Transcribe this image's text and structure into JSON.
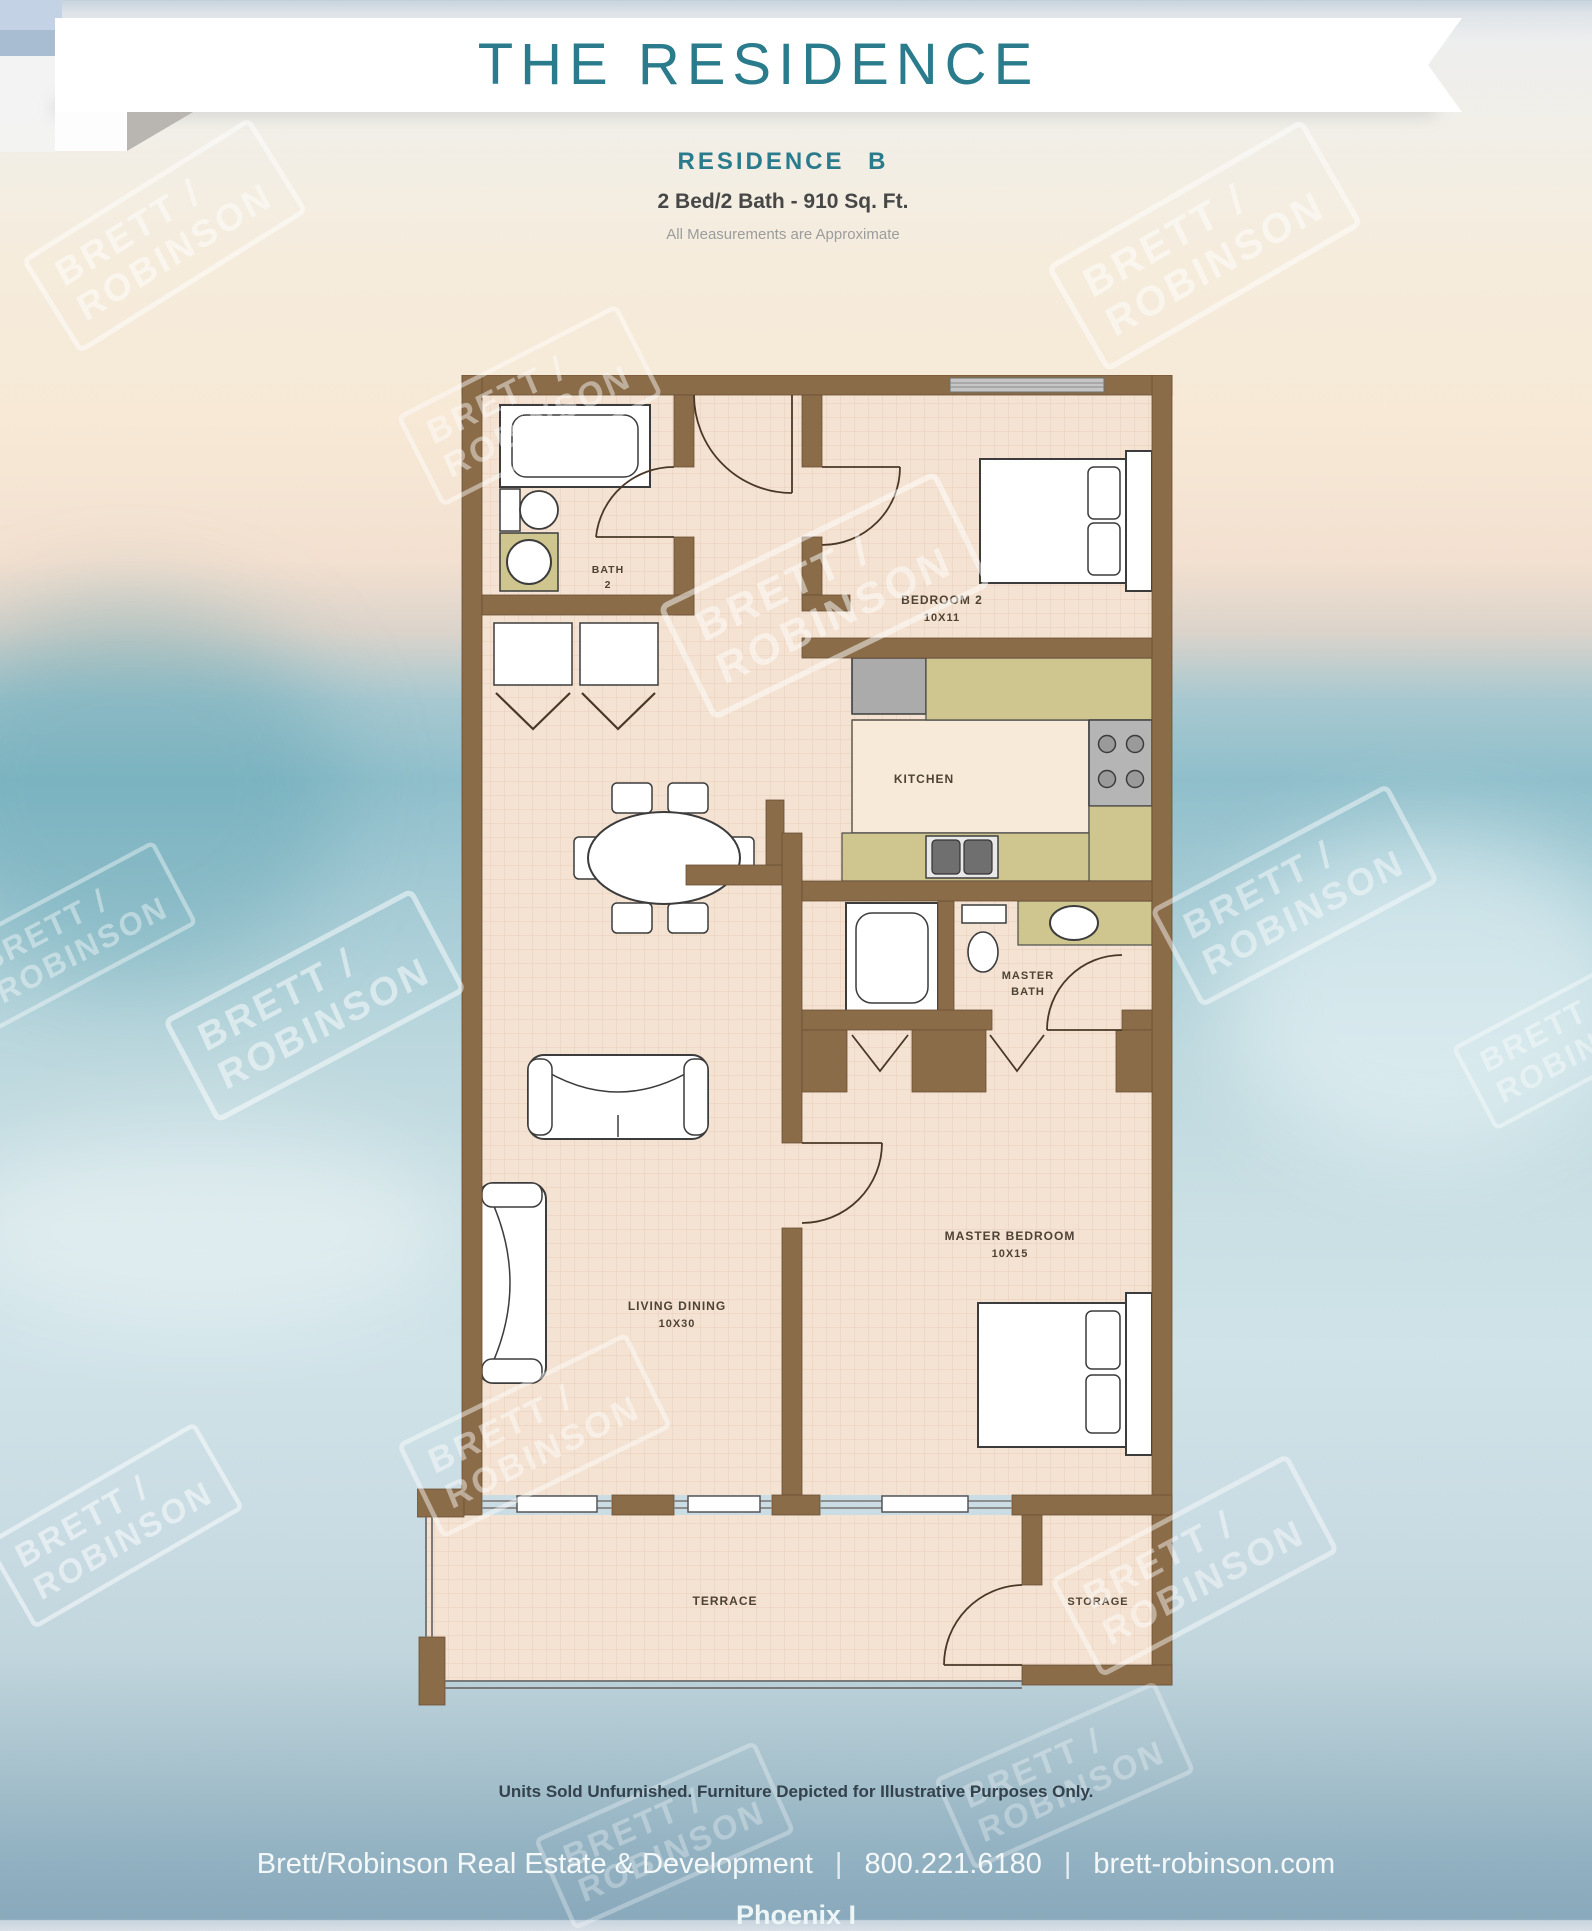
{
  "banner": {
    "title": "THE RESIDENCE"
  },
  "subtitle": {
    "residence": "RESIDENCE B",
    "specs": "2 Bed/2 Bath - 910 Sq. Ft.",
    "note": "All Measurements are Approximate"
  },
  "floorplan": {
    "rooms": {
      "bath2": {
        "line1": "BATH",
        "line2": "2"
      },
      "bedroom2": {
        "name": "BEDROOM 2",
        "dims": "10X11"
      },
      "kitchen": {
        "name": "KITCHEN"
      },
      "master_bath": {
        "line1": "MASTER",
        "line2": "BATH"
      },
      "master_bedroom": {
        "name": "MASTER BEDROOM",
        "dims": "10X15"
      },
      "living_dining": {
        "name": "LIVING DINING",
        "dims": "10X30"
      },
      "terrace": {
        "name": "TERRACE"
      },
      "storage": {
        "name": "STORAGE"
      }
    }
  },
  "watermark": {
    "line1": "BRETT /",
    "line2": "ROBINSON",
    "instances": [
      {
        "left": 30,
        "top": 180,
        "rot": -32,
        "scale": 1.0,
        "op": 0.5
      },
      {
        "left": 395,
        "top": 350,
        "rot": -27,
        "scale": 0.92,
        "op": 0.45
      },
      {
        "left": 1070,
        "top": 190,
        "rot": -30,
        "scale": 1.1,
        "op": 0.5
      },
      {
        "left": 690,
        "top": 540,
        "rot": -26,
        "scale": 1.15,
        "op": 0.5
      },
      {
        "left": 1160,
        "top": 840,
        "rot": -28,
        "scale": 1.0,
        "op": 0.45
      },
      {
        "left": 180,
        "top": 950,
        "rot": -28,
        "scale": 1.05,
        "op": 0.5
      },
      {
        "left": 400,
        "top": 1380,
        "rot": -26,
        "scale": 0.95,
        "op": 0.45
      },
      {
        "left": -20,
        "top": 1470,
        "rot": -30,
        "scale": 0.9,
        "op": 0.5
      },
      {
        "left": 1060,
        "top": 1510,
        "rot": -28,
        "scale": 1.0,
        "op": 0.45
      },
      {
        "left": 530,
        "top": 1780,
        "rot": -24,
        "scale": 0.9,
        "op": 0.3
      },
      {
        "left": 930,
        "top": 1720,
        "rot": -24,
        "scale": 0.9,
        "op": 0.3
      },
      {
        "left": 1440,
        "top": 980,
        "rot": -28,
        "scale": 0.85,
        "op": 0.4
      },
      {
        "left": -60,
        "top": 880,
        "rot": -28,
        "scale": 0.85,
        "op": 0.4
      }
    ]
  },
  "footer": {
    "disclaimer": "Units Sold Unfurnished. Furniture Depicted for Illustrative Purposes Only.",
    "company": "Brett/Robinson Real Estate & Development",
    "phone": "800.221.6180",
    "website": "brett-robinson.com",
    "separator": "|",
    "building": "Phoenix I"
  },
  "colors": {
    "accent_teal": "#2a7c8c",
    "wall_brown": "#8a6c49",
    "counter_olive": "#cfc68f",
    "floor": "#f4e2d2",
    "appliance_gray": "#ababab",
    "footer_band_blue": "#8fb0c0"
  }
}
